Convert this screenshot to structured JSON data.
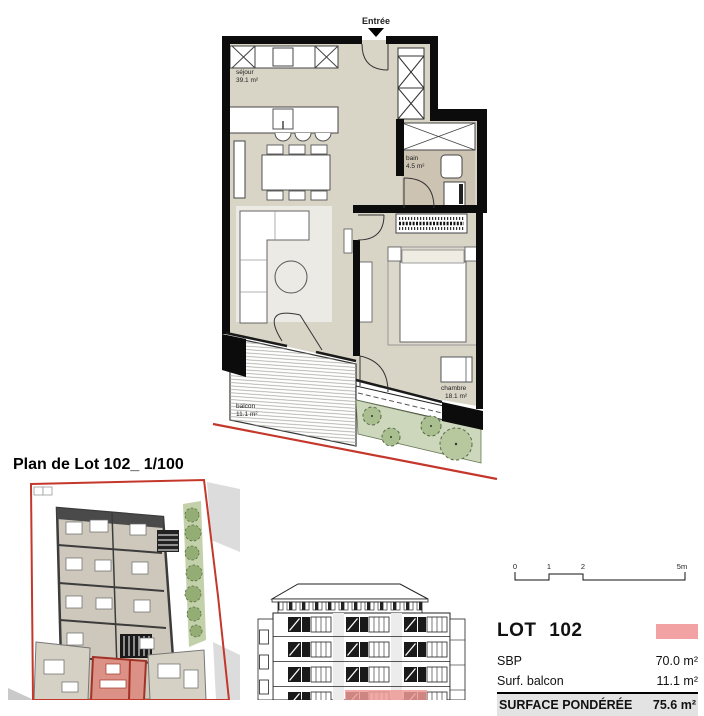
{
  "title": "Plan de Lot 102_ 1/100",
  "plan": {
    "entry_label": "Entrée",
    "rooms": [
      {
        "name": "séjour",
        "area": "39.1 m²"
      },
      {
        "name": "bain",
        "area": "4.5 m²"
      },
      {
        "name": "chambre",
        "area": "18.1 m²"
      },
      {
        "name": "balcon",
        "area": "11.1 m²"
      }
    ]
  },
  "scale_bar": {
    "ticks": [
      "0",
      "1",
      "2",
      "5m"
    ]
  },
  "lot_info": {
    "heading": "LOT 102",
    "swatch_color": "#f2a2a2",
    "rows": [
      {
        "label": "SBP",
        "value": "70.0 m²"
      },
      {
        "label": "Surf. balcon",
        "value": "11.1 m²"
      },
      {
        "label": "SURFACE PONDÉRÉE",
        "value": "75.6 m²"
      }
    ]
  },
  "colors": {
    "boundary_red": "#c4372b",
    "lot_swatch": "#f2a2a2",
    "floor_beige": "#d8d4c6",
    "bath_floor": "#cdc3b2",
    "garden_green": "#ccd7bc",
    "bush_green": "#a9bf90",
    "facade_highlight": "#ee9a96"
  }
}
